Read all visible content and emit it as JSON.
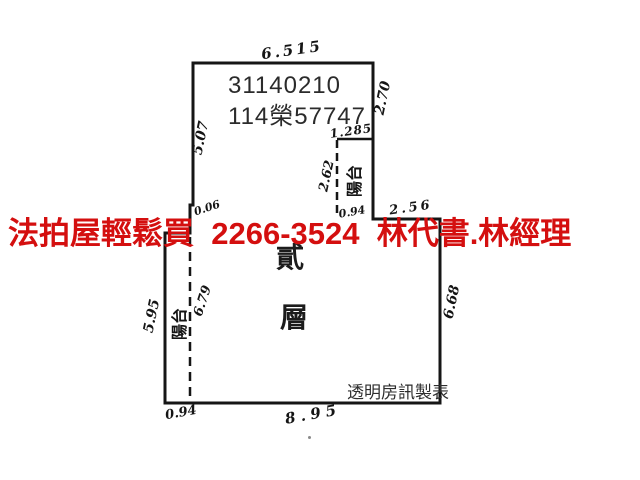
{
  "page": {
    "background": "#ffffff",
    "line_color": "#151515"
  },
  "plan": {
    "case_number": {
      "line1": "31140210",
      "line2": "114榮57747"
    },
    "floor_label": {
      "char1": "貳",
      "char2": "層",
      "meaning": "second floor"
    },
    "maker_credit": "透明房訊製表",
    "balcony_right_label": "陽台",
    "balcony_left_label": "陽台",
    "dimensions": {
      "top_width": "6.515",
      "upper_left_height": "5.07",
      "upper_right_height": "2.70",
      "right_step_width": "1.285",
      "right_balcony_height": "2.62",
      "right_balcony_width": "0.94",
      "right_ledge_width": "2.56",
      "left_jog": "0.06",
      "lower_left_height": "5.95",
      "left_balcony_length": "6.79",
      "lower_right_height": "6.68",
      "bottom_left_width": "0.94",
      "bottom_width": "8.95"
    }
  },
  "watermark": {
    "text": "法拍屋輕鬆買  2266-3524  林代書.林經理",
    "color": "#d40f0f"
  }
}
